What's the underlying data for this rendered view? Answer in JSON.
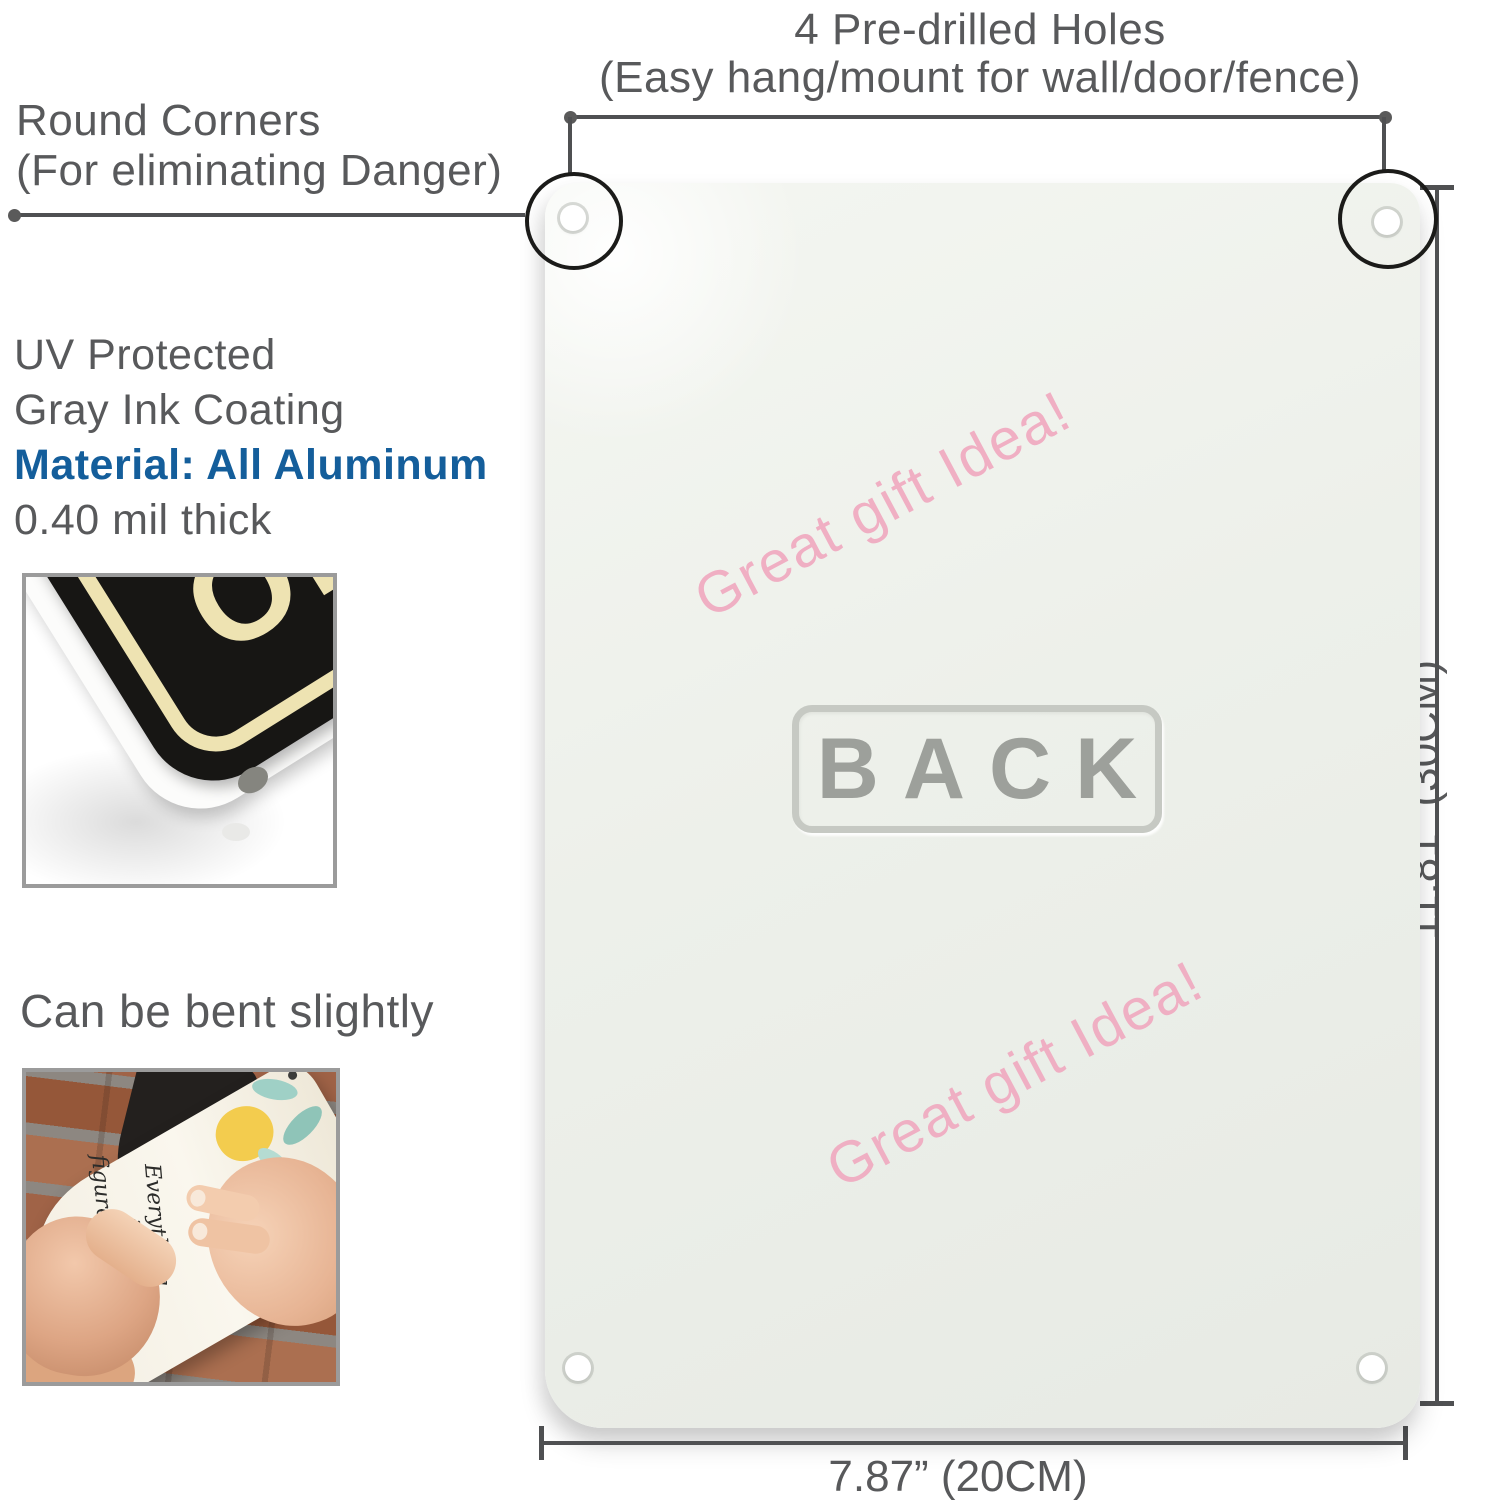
{
  "colors": {
    "text_gray": "#58595b",
    "line_gray": "#4f5052",
    "accent_blue": "#145e9b",
    "watermark_pink": "#f0aac0",
    "sign_face": "#edf0ea",
    "back_gray": "#9da09b"
  },
  "top_note": {
    "line1": "4 Pre-drilled Holes",
    "line2": "(Easy hang/mount for wall/door/fence)"
  },
  "corner_note": {
    "line1": "Round Corners",
    "line2": "(For eliminating Danger)"
  },
  "material_note": {
    "line1": "UV Protected",
    "line2": "Gray Ink Coating",
    "line3": "Material: All Aluminum",
    "line4": "0.40 mil thick"
  },
  "bend_note": {
    "text": "Can be bent slightly"
  },
  "inset_photo_sign": {
    "letter_line1": "D",
    "letter_line2": "OR R"
  },
  "inset_photo_bend": {
    "script_line1": "Everything",
    "script_line2": "is",
    "script_line3": "figureoutable"
  },
  "sign_back": {
    "label": "BACK",
    "watermark": "Great gift Idea!"
  },
  "dimensions": {
    "height_label": "11.81” (30CM)",
    "width_label": "7.87” (20CM)"
  }
}
